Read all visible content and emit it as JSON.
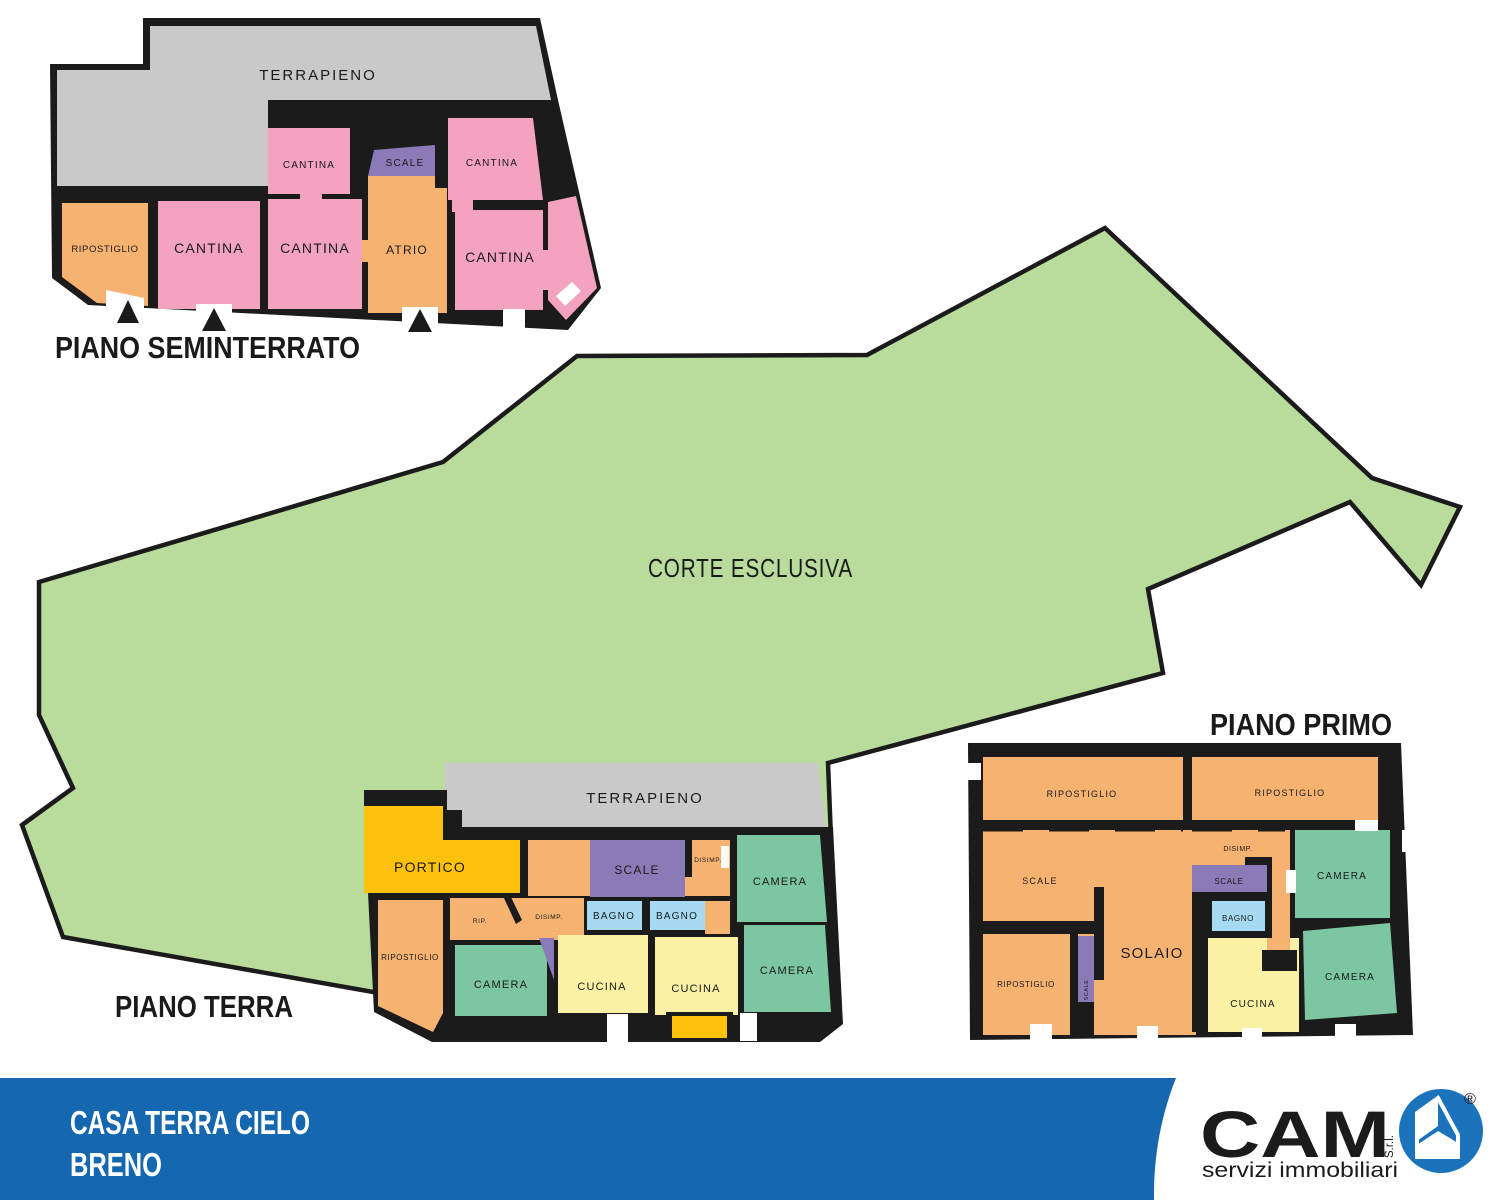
{
  "palette": {
    "wall": "#1b1b1b",
    "terrapieno": "#c9c9c9",
    "cantina": "#f3a2c0",
    "orange": "#f6b270",
    "scale": "#8a7bb8",
    "green": "#b9dc9d",
    "portico": "#fec20d",
    "camera": "#7cc6a1",
    "bagno": "#a5daf2",
    "cucina": "#faf1a4",
    "banner_blue": "#1568b0",
    "logo_blue": "#1b74bb",
    "white": "#ffffff",
    "text": "#1a1a1a"
  },
  "corte": {
    "label": "CORTE ESCLUSIVA"
  },
  "floors": {
    "seminterrato": {
      "title": "PIANO SEMINTERRATO",
      "labels": {
        "terrapieno": "TERRAPIENO",
        "cantina_small": "CANTINA",
        "cantina_tr": "CANTINA",
        "scale": "SCALE",
        "ripostiglio": "RIPOSTIGLIO",
        "cantina_1": "CANTINA",
        "cantina_2": "CANTINA",
        "atrio": "ATRIO",
        "cantina_br": "CANTINA"
      }
    },
    "terra": {
      "title": "PIANO TERRA",
      "labels": {
        "terrapieno": "TERRAPIENO",
        "portico": "PORTICO",
        "scale": "SCALE",
        "disimp_top": "DISIMP.",
        "camera_tr": "CAMERA",
        "rip": "RIP.",
        "disimp": "DISIMP.",
        "bagno_1": "BAGNO",
        "bagno_2": "BAGNO",
        "ripostiglio": "RIPOSTIGLIO",
        "camera_bl": "CAMERA",
        "cucina_1": "CUCINA",
        "cucina_2": "CUCINA",
        "camera_br": "CAMERA"
      }
    },
    "primo": {
      "title": "PIANO PRIMO",
      "labels": {
        "ripostiglio_tl": "RIPOSTIGLIO",
        "ripostiglio_tr": "RIPOSTIGLIO",
        "scale_left": "SCALE",
        "disimp": "DISIMP.",
        "scale_mid": "SCALE",
        "bagno": "BAGNO",
        "camera_tr": "CAMERA",
        "camera_br": "CAMERA",
        "solaio": "SOLAIO",
        "ripostiglio_bl": "RIPOSTIGLIO",
        "scale_small": "SCALE",
        "cucina": "CUCINA"
      }
    }
  },
  "banner": {
    "line1": "CASA TERRA CIELO",
    "line2": "BRENO"
  },
  "logo": {
    "brand": "CAM",
    "suffix": "S.r.l.",
    "registered": "®",
    "tagline": "servizi immobiliari"
  }
}
